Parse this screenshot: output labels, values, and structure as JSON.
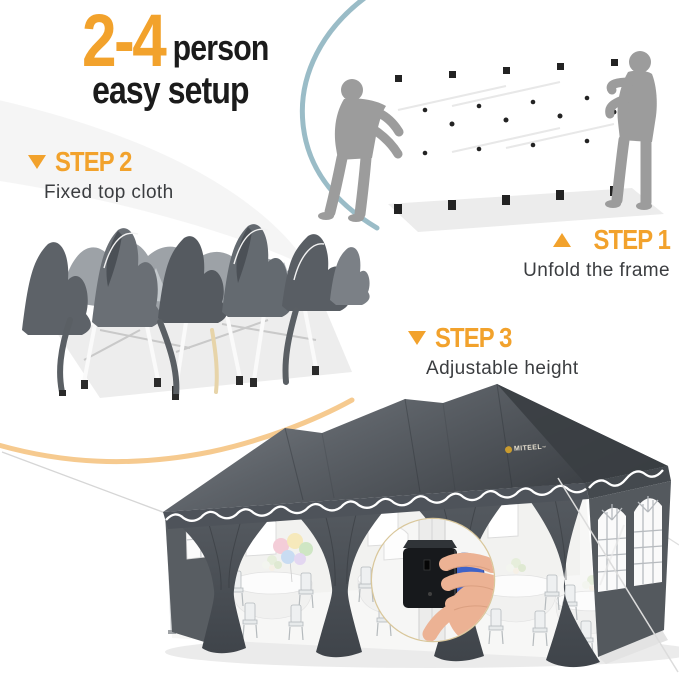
{
  "meta": {
    "title": "2-4 person easy setup canopy instructions"
  },
  "heading": {
    "highlight": "2-4",
    "suffix": "person",
    "line2": "easy setup"
  },
  "steps": [
    {
      "label": "STEP 1",
      "caption": "Unfold the frame",
      "marker": "triangle-up"
    },
    {
      "label": "STEP 2",
      "caption": "Fixed top cloth",
      "marker": "triangle-down"
    },
    {
      "label": "STEP 3",
      "caption": "Adjustable height",
      "marker": "triangle-down"
    }
  ],
  "tent": {
    "brand": "MITEEL",
    "trademark": "™"
  },
  "scenes": {
    "step1_image": "two-people-unfolding-white-canopy-frame",
    "step2_image": "folded-canopy-with-fixed-gray-top-cloth",
    "step3_image": "assembled-gray-party-canopy-with-height-adjust-inset"
  },
  "colors": {
    "accent_orange": "#F2A22C",
    "swoosh_orange": "#F6CA8F",
    "arc_teal": "#8FB5C1",
    "silhouette_gray": "#9C9C9C",
    "tent_gray_dark": "#43474C",
    "tent_gray": "#565B60",
    "text_dark": "#1B1B1B",
    "caption_gray": "#3B3D40",
    "handle_blue": "#3F63C8",
    "hand_skin": "#ECB294",
    "inset_ring": "#D9C79B"
  }
}
